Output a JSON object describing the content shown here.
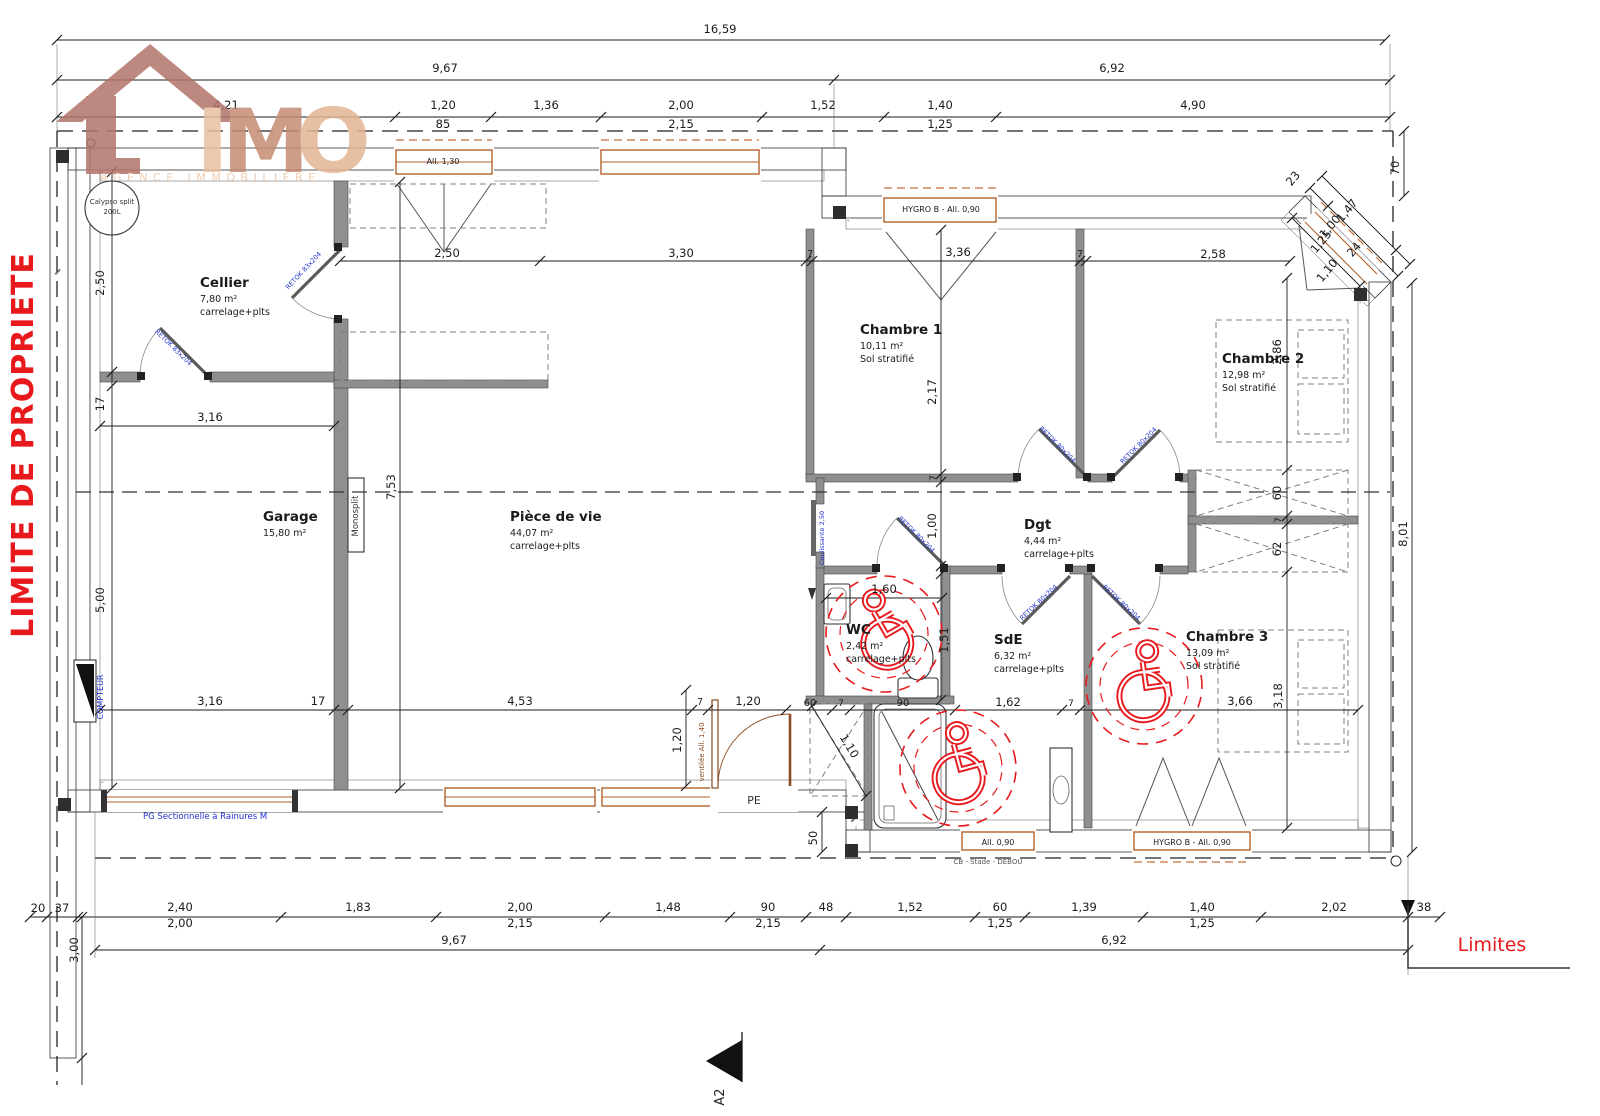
{
  "logo": {
    "letter_i": "I",
    "letter_m": "M",
    "letter_o": "O",
    "tagline": "AGENCE IMMOBILIERE"
  },
  "red": {
    "limite": "LIMITE DE PROPRIETE",
    "limites": "Limites"
  },
  "colors": {
    "accent_red": "#e8191c",
    "door_blue": "#2233cc",
    "wood": "#b4622a",
    "logo_dark": "#b1746a",
    "logo_light": "#e3b695"
  },
  "rooms": [
    {
      "id": "cellier",
      "name": "Cellier",
      "area": "7,80 m²",
      "floor": "carrelage+plts",
      "x": 200,
      "y": 287
    },
    {
      "id": "garage",
      "name": "Garage",
      "area": "15,80 m²",
      "floor": "",
      "x": 263,
      "y": 521
    },
    {
      "id": "piece-de-vie",
      "name": "Pièce de vie",
      "area": "44,07 m²",
      "floor": "carrelage+plts",
      "x": 510,
      "y": 521
    },
    {
      "id": "chambre-1",
      "name": "Chambre 1",
      "area": "10,11 m²",
      "floor": "Sol stratifié",
      "x": 860,
      "y": 334
    },
    {
      "id": "chambre-2",
      "name": "Chambre 2",
      "area": "12,98 m²",
      "floor": "Sol stratifié",
      "x": 1222,
      "y": 363
    },
    {
      "id": "dgt",
      "name": "Dgt",
      "area": "4,44 m²",
      "floor": "carrelage+plts",
      "x": 1024,
      "y": 529
    },
    {
      "id": "wc",
      "name": "WC",
      "area": "2,42 m²",
      "floor": "carrelage+plts",
      "x": 846,
      "y": 634
    },
    {
      "id": "sde",
      "name": "SdE",
      "area": "6,32 m²",
      "floor": "carrelage+plts",
      "x": 994,
      "y": 644
    },
    {
      "id": "chambre-3",
      "name": "Chambre 3",
      "area": "13,09 m²",
      "floor": "Sol stratifié",
      "x": 1186,
      "y": 641
    }
  ],
  "windows": [
    {
      "label": "All. 1,30",
      "x": 443,
      "y": 164
    },
    {
      "label": "HYGRO B - All. 0,90",
      "x": 941,
      "y": 212
    },
    {
      "label": "All. 0,90",
      "x": 998,
      "y": 845
    },
    {
      "label": "HYGRO B - All. 0,90",
      "x": 1192,
      "y": 845
    }
  ],
  "annotations": [
    {
      "t": "Calypso split",
      "x": 112,
      "y": 204,
      "s": 7,
      "c": "#333"
    },
    {
      "t": "200L",
      "x": 112,
      "y": 214,
      "s": 7,
      "c": "#333"
    },
    {
      "t": "Monosplit",
      "x": 358,
      "y": 516,
      "r": -90,
      "s": 8.5,
      "c": "#333"
    },
    {
      "t": "COMPTEUR",
      "x": 103,
      "y": 697,
      "r": -90,
      "s": 8,
      "c": "#2233cc"
    },
    {
      "t": "PG Sectionnelle à Rainures M",
      "x": 143,
      "y": 819,
      "s": 8.5,
      "c": "#2233cc",
      "a": "start"
    },
    {
      "t": "PE",
      "x": 754,
      "y": 804,
      "s": 11,
      "c": "#333"
    },
    {
      "t": "ventilée All. 1,40",
      "x": 704,
      "y": 752,
      "r": -90,
      "s": 7,
      "c": "#8a4b20"
    },
    {
      "t": "Coulissante 2,50",
      "x": 824,
      "y": 538,
      "r": -90,
      "s": 6.5,
      "c": "#2233cc"
    },
    {
      "t": "CB - Stade - DEBOU",
      "x": 988,
      "y": 864,
      "s": 7,
      "c": "#555"
    },
    {
      "t": "A2",
      "x": 724,
      "y": 1097,
      "r": -90,
      "s": 13,
      "c": "#222"
    }
  ],
  "door_tags": [
    {
      "t": "RETOK 83x204",
      "x": 172,
      "y": 349,
      "r": 44
    },
    {
      "t": "RETOK 83x204",
      "x": 305,
      "y": 272,
      "r": -47
    },
    {
      "t": "RETOK 80x204",
      "x": 1056,
      "y": 446,
      "r": 45
    },
    {
      "t": "RETOK 80x204",
      "x": 1140,
      "y": 447,
      "r": -45
    },
    {
      "t": "RETOK 80x204",
      "x": 915,
      "y": 536,
      "r": 45
    },
    {
      "t": "RETOK 80x204",
      "x": 1040,
      "y": 604,
      "r": -43
    },
    {
      "t": "RETOK 80x204",
      "x": 1120,
      "y": 604,
      "r": 43
    }
  ],
  "dimensions": [
    {
      "t": "16,59",
      "x": 720,
      "y": 33
    },
    {
      "t": "9,67",
      "x": 445,
      "y": 72
    },
    {
      "t": "6,92",
      "x": 1112,
      "y": 72
    },
    {
      "t": "4,21",
      "x": 226,
      "y": 109
    },
    {
      "t": "1,20",
      "x": 443,
      "y": 109
    },
    {
      "t": "1,36",
      "x": 546,
      "y": 109
    },
    {
      "t": "2,00",
      "x": 681,
      "y": 109
    },
    {
      "t": "1,52",
      "x": 823,
      "y": 109
    },
    {
      "t": "1,40",
      "x": 940,
      "y": 109
    },
    {
      "t": "4,90",
      "x": 1193,
      "y": 109
    },
    {
      "t": "85",
      "x": 443,
      "y": 128
    },
    {
      "t": "2,15",
      "x": 681,
      "y": 128
    },
    {
      "t": "1,25",
      "x": 940,
      "y": 128
    },
    {
      "t": "70",
      "x": 1399,
      "y": 168,
      "r": -90
    },
    {
      "t": "23",
      "x": 1296,
      "y": 181,
      "r": -50
    },
    {
      "t": "1,47",
      "x": 1350,
      "y": 213,
      "r": -50
    },
    {
      "t": "1,00",
      "x": 1333,
      "y": 229,
      "r": -50
    },
    {
      "t": "1,25",
      "x": 1324,
      "y": 244,
      "r": -50
    },
    {
      "t": "24",
      "x": 1357,
      "y": 252,
      "r": -50
    },
    {
      "t": "1,10",
      "x": 1330,
      "y": 273,
      "r": -50
    },
    {
      "t": "2,50",
      "x": 104,
      "y": 283,
      "r": -90
    },
    {
      "t": "17",
      "x": 104,
      "y": 404,
      "r": -90
    },
    {
      "t": "5,00",
      "x": 104,
      "y": 600,
      "r": -90
    },
    {
      "t": "3,16",
      "x": 210,
      "y": 421
    },
    {
      "t": "2,50",
      "x": 447,
      "y": 257
    },
    {
      "t": "3,30",
      "x": 681,
      "y": 257
    },
    {
      "t": "7",
      "x": 810,
      "y": 257,
      "s": 9.5
    },
    {
      "t": "3,36",
      "x": 958,
      "y": 256
    },
    {
      "t": "7",
      "x": 1080,
      "y": 257,
      "s": 9.5
    },
    {
      "t": "2,58",
      "x": 1213,
      "y": 258
    },
    {
      "t": "7,53",
      "x": 395,
      "y": 487,
      "r": -90
    },
    {
      "t": "2,17",
      "x": 936,
      "y": 392,
      "r": -90
    },
    {
      "t": "7",
      "x": 936,
      "y": 478,
      "r": -90,
      "s": 9
    },
    {
      "t": "1,00",
      "x": 936,
      "y": 526,
      "r": -90
    },
    {
      "t": "1,51",
      "x": 948,
      "y": 640,
      "r": -90
    },
    {
      "t": "1,60",
      "x": 884,
      "y": 593
    },
    {
      "t": "2,86",
      "x": 1281,
      "y": 352,
      "r": -90
    },
    {
      "t": "60",
      "x": 1281,
      "y": 493,
      "r": -90
    },
    {
      "t": "7",
      "x": 1281,
      "y": 520,
      "r": -90,
      "s": 9
    },
    {
      "t": "62",
      "x": 1281,
      "y": 549,
      "r": -90
    },
    {
      "t": "3,18",
      "x": 1282,
      "y": 696,
      "r": -90
    },
    {
      "t": "8,01",
      "x": 1407,
      "y": 534,
      "r": -90
    },
    {
      "t": "3,16",
      "x": 210,
      "y": 705
    },
    {
      "t": "17",
      "x": 318,
      "y": 705
    },
    {
      "t": "4,53",
      "x": 520,
      "y": 705
    },
    {
      "t": "7",
      "x": 700,
      "y": 705,
      "s": 9.5
    },
    {
      "t": "1,20",
      "x": 748,
      "y": 705
    },
    {
      "t": "60",
      "x": 810,
      "y": 706,
      "s": 10
    },
    {
      "t": "7",
      "x": 841,
      "y": 706,
      "s": 9
    },
    {
      "t": "90",
      "x": 903,
      "y": 706,
      "s": 10
    },
    {
      "t": "1,62",
      "x": 1008,
      "y": 706
    },
    {
      "t": "7",
      "x": 1071,
      "y": 706,
      "s": 9
    },
    {
      "t": "3,66",
      "x": 1240,
      "y": 705
    },
    {
      "t": "1,20",
      "x": 681,
      "y": 740,
      "r": -90
    },
    {
      "t": "1,10",
      "x": 846,
      "y": 748,
      "r": 59
    },
    {
      "t": "50",
      "x": 817,
      "y": 838,
      "r": -90
    },
    {
      "t": "20",
      "x": 38,
      "y": 912
    },
    {
      "t": "37",
      "x": 62,
      "y": 912
    },
    {
      "t": "2,40",
      "x": 180,
      "y": 911
    },
    {
      "t": "2,00",
      "x": 180,
      "y": 927
    },
    {
      "t": "1,83",
      "x": 358,
      "y": 911
    },
    {
      "t": "2,00",
      "x": 520,
      "y": 911
    },
    {
      "t": "2,15",
      "x": 520,
      "y": 927
    },
    {
      "t": "1,48",
      "x": 668,
      "y": 911
    },
    {
      "t": "90",
      "x": 768,
      "y": 911
    },
    {
      "t": "2,15",
      "x": 768,
      "y": 927
    },
    {
      "t": "48",
      "x": 826,
      "y": 911
    },
    {
      "t": "1,52",
      "x": 910,
      "y": 911
    },
    {
      "t": "60",
      "x": 1000,
      "y": 911
    },
    {
      "t": "1,25",
      "x": 1000,
      "y": 927
    },
    {
      "t": "1,39",
      "x": 1084,
      "y": 911
    },
    {
      "t": "1,40",
      "x": 1202,
      "y": 911
    },
    {
      "t": "1,25",
      "x": 1202,
      "y": 927
    },
    {
      "t": "2,02",
      "x": 1334,
      "y": 911
    },
    {
      "t": "38",
      "x": 1424,
      "y": 911
    },
    {
      "t": "9,67",
      "x": 454,
      "y": 944
    },
    {
      "t": "6,92",
      "x": 1114,
      "y": 944
    },
    {
      "t": "3,00",
      "x": 78,
      "y": 950,
      "r": -90
    }
  ]
}
